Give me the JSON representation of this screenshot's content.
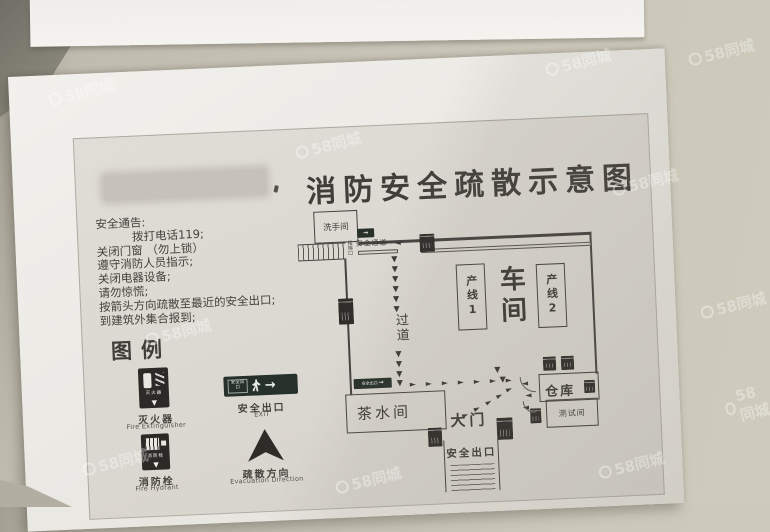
{
  "watermark": {
    "text": "58同城"
  },
  "poster": {
    "title": "消防安全疏散示意图",
    "notice": {
      "heading": "安全通告:",
      "lines": [
        "拨打电话119;",
        "关闭门窗 （勿上锁）",
        "遵守消防人员指示;",
        "关闭电器设备;",
        "请勿惊慌;",
        "按箭头方向疏散至最近的安全出口;",
        "到建筑外集合报到;"
      ]
    },
    "legend": {
      "heading": "图例",
      "items": [
        {
          "label_zh": "灭火器",
          "label_en": "Fire Extinguisher"
        },
        {
          "label_zh": "安全出口",
          "label_en": "EXIT"
        },
        {
          "label_zh": "消防栓",
          "label_en": "Fire Hydrant"
        },
        {
          "label_zh": "疏散方向",
          "label_en": "Evacuation Direction"
        }
      ]
    },
    "plan": {
      "washroom": "洗手间",
      "stairs": "楼梯口",
      "passage": "安全通道",
      "corridor": "过道",
      "line1": "产线1",
      "workshop": "车间",
      "line2": "产线2",
      "warehouse": "仓库",
      "test_room": "测试间",
      "tea_room": "茶水间",
      "gate": "大门",
      "exit": "安全出口",
      "mini_sign": "安全出口"
    }
  }
}
